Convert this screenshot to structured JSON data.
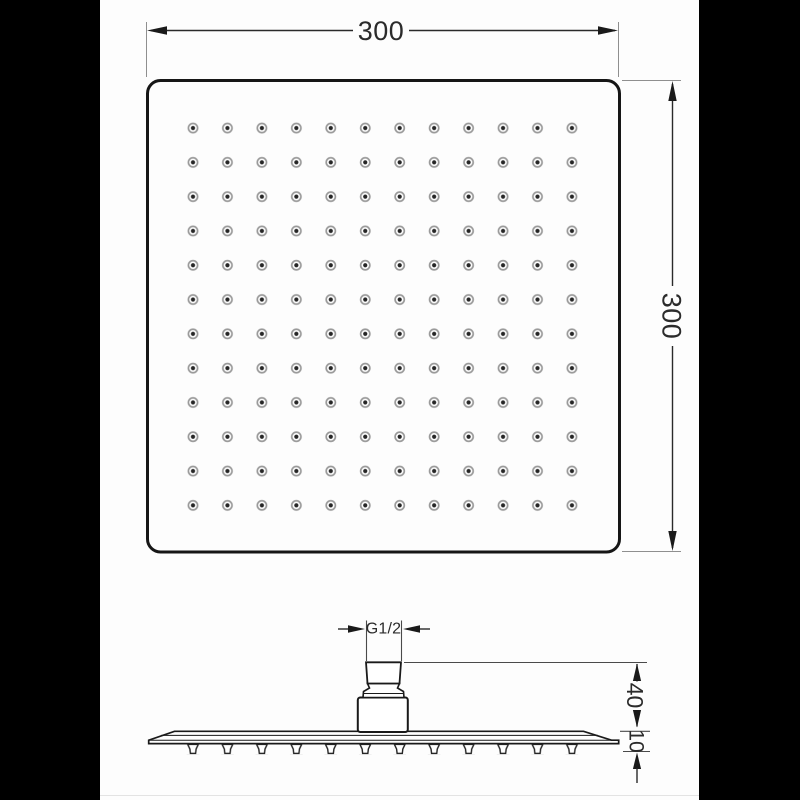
{
  "dimensions": {
    "width": "300",
    "height": "300",
    "thread": "G1/2",
    "arm_height": "40",
    "plate_thickness": "10"
  },
  "grid": {
    "rows": 12,
    "cols": 12
  },
  "colors": {
    "background": "#000000",
    "canvas": "#ffffff",
    "line": "#1a1a1a",
    "nozzle_ring": "#9a9a9a",
    "nozzle_center": "#262626"
  }
}
